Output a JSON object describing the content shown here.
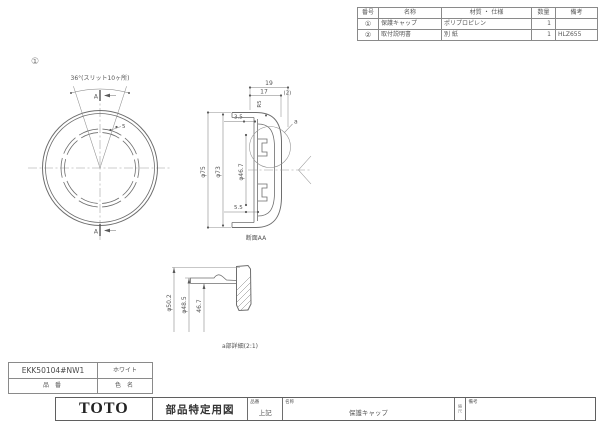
{
  "parts_table": {
    "headers": [
      "番号",
      "名称",
      "材質 ・ 仕様",
      "数量",
      "備考"
    ],
    "rows": [
      {
        "no": "①",
        "name": "保護キャップ",
        "material": "ポリプロピレン",
        "qty": "1",
        "remark": ""
      },
      {
        "no": "②",
        "name": "取付説明書",
        "material": "別  紙",
        "qty": "1",
        "remark": "HLZ655"
      }
    ]
  },
  "front_view": {
    "balloon": "①",
    "angle_note": "36°(スリット10ヶ所)",
    "slit_width": "5",
    "section_arrow": "A"
  },
  "section_view": {
    "dim_19": "19",
    "dim_17": "17",
    "dim_2": "(2)",
    "radius_r5": "R5",
    "dim_3_5": "3.5",
    "dim_5_5": "5.5",
    "dia_75": "φ75",
    "dia_73": "φ73",
    "dia_46_7": "φ46.7",
    "detail_ref": "a",
    "caption": "断面AA"
  },
  "detail_view": {
    "dia_50_2": "φ50.2",
    "dia_48_5": "φ48.5",
    "dim_46_7": "46.7",
    "caption": "a部詳細(2:1)"
  },
  "id_table": {
    "part_number": "EKK50104#NW1",
    "color_value": "ホワイト",
    "part_number_label": "品 番",
    "color_label": "色 名"
  },
  "title_block": {
    "logo": "TOTO",
    "doc_type": "部品特定用図",
    "part_no_label": "品番",
    "part_no_value": "上記",
    "name_label": "名称",
    "name_value": "保護キャップ",
    "scale_label": "縮尺",
    "remarks_label": "備考",
    "remarks_value": ""
  }
}
